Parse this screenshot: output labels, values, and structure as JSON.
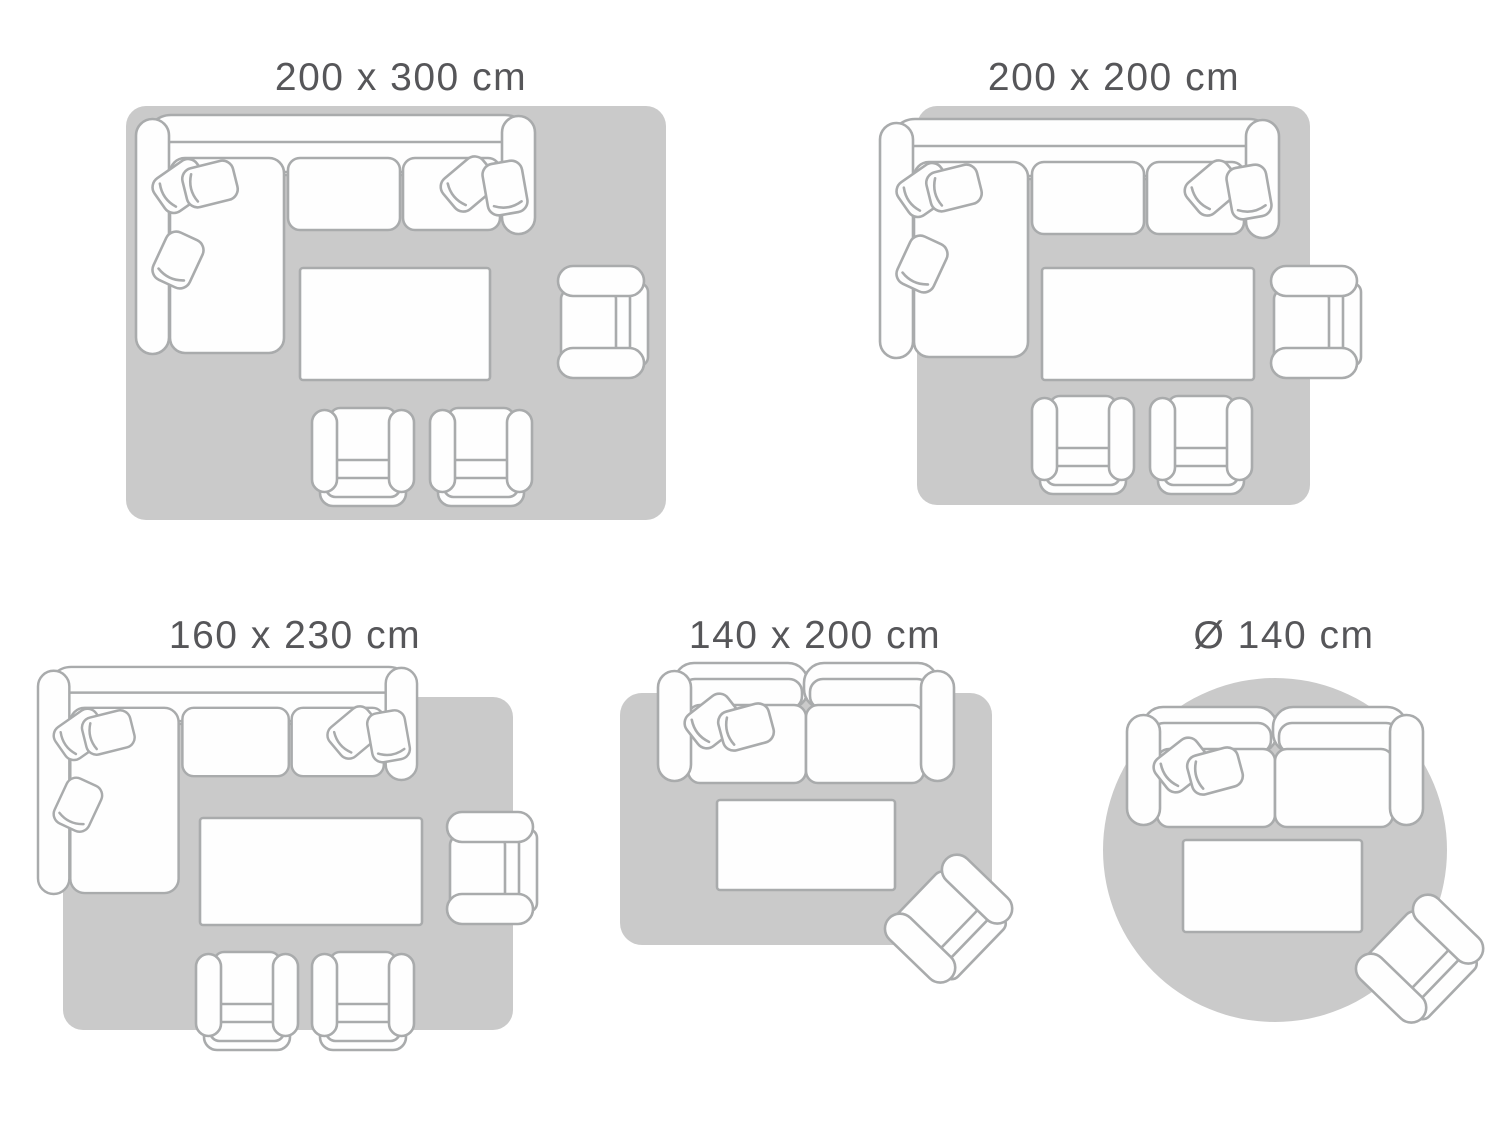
{
  "colors": {
    "background": "#ffffff",
    "rug": "#cacaca",
    "furniture_fill": "#fefefe",
    "furniture_stroke": "#a9abac",
    "label_text": "#565659"
  },
  "panels": [
    {
      "label": "200 x 300 cm",
      "rug_shape": "rectangle",
      "furniture": [
        "corner-sofa",
        "coffee-table",
        "armchair",
        "club-chair",
        "club-chair"
      ]
    },
    {
      "label": "200 x 200 cm",
      "rug_shape": "square",
      "furniture": [
        "corner-sofa",
        "coffee-table",
        "armchair",
        "club-chair",
        "club-chair"
      ]
    },
    {
      "label": "160 x 230 cm",
      "rug_shape": "rectangle",
      "furniture": [
        "corner-sofa",
        "coffee-table",
        "armchair",
        "club-chair",
        "club-chair"
      ]
    },
    {
      "label": "140 x 200 cm",
      "rug_shape": "rectangle",
      "furniture": [
        "two-seater-sofa",
        "coffee-table",
        "armchair"
      ]
    },
    {
      "label": "Ø 140 cm",
      "rug_shape": "round",
      "furniture": [
        "two-seater-sofa",
        "coffee-table",
        "armchair"
      ]
    }
  ]
}
